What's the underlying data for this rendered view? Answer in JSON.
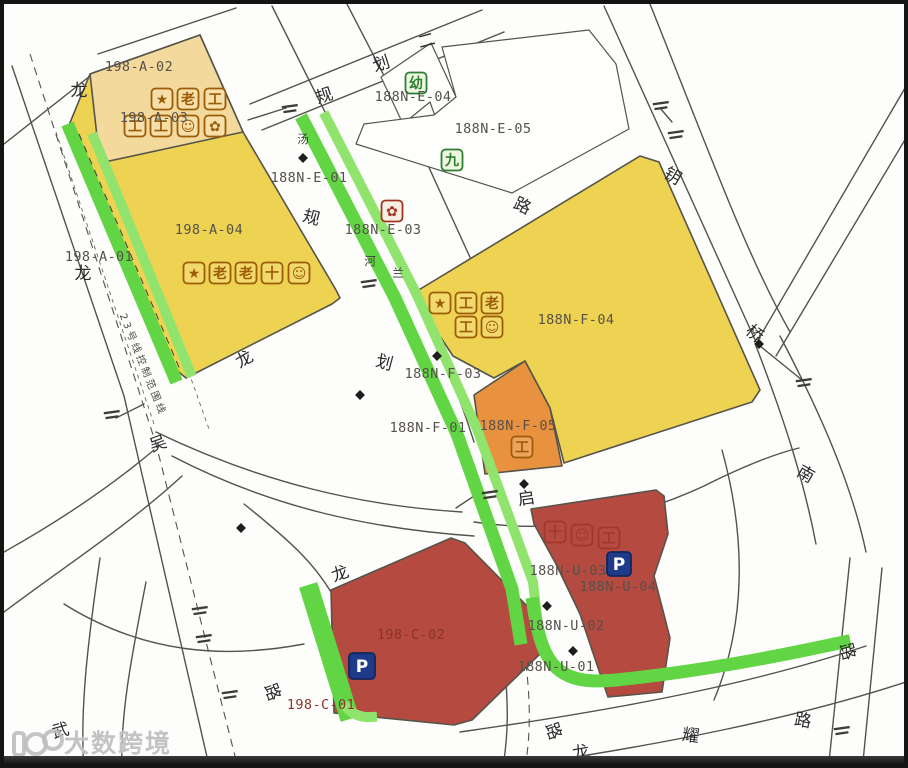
{
  "watermark": {
    "text": "大数跨境"
  },
  "colors": {
    "greenway": "#62d544",
    "greenway_light": "#90e46e",
    "parcel_yellow": "#eed252",
    "parcel_tan": "#f4d99c",
    "parcel_orange": "#e8913f",
    "parcel_red": "#b54a40",
    "parking_blue": "#1e3a8a",
    "icon_brown": "#9c5c08",
    "icon_green": "#2e7d32",
    "icon_red": "#a33322",
    "road_line": "#54524c",
    "label_gray": "#56514b",
    "label_red": "#8a342c"
  },
  "map": {
    "labels": [
      {
        "t": "198-A-02",
        "x": 135,
        "y": 67,
        "cls": "pl",
        "name": "parcel-label-198-a-02"
      },
      {
        "t": "198-A-03",
        "x": 150,
        "y": 118,
        "cls": "pl",
        "name": "parcel-label-198-a-03"
      },
      {
        "t": "198-A-04",
        "x": 205,
        "y": 230,
        "cls": "pl",
        "name": "parcel-label-198-a-04"
      },
      {
        "t": "198-A-01",
        "x": 95,
        "y": 257,
        "cls": "pl",
        "name": "parcel-label-198-a-01"
      },
      {
        "t": "188N-E-04",
        "x": 409,
        "y": 97,
        "cls": "pl",
        "name": "parcel-label-188n-e-04"
      },
      {
        "t": "188N-E-05",
        "x": 489,
        "y": 129,
        "cls": "pl",
        "name": "parcel-label-188n-e-05"
      },
      {
        "t": "188N-E-01",
        "x": 305,
        "y": 178,
        "cls": "pl",
        "name": "parcel-label-188n-e-01"
      },
      {
        "t": "188N-E-03",
        "x": 379,
        "y": 230,
        "cls": "pl",
        "name": "parcel-label-188n-e-03"
      },
      {
        "t": "188N-F-04",
        "x": 572,
        "y": 320,
        "cls": "pl",
        "name": "parcel-label-188n-f-04"
      },
      {
        "t": "188N-F-03",
        "x": 439,
        "y": 374,
        "cls": "pl",
        "name": "parcel-label-188n-f-03"
      },
      {
        "t": "188N-F-01",
        "x": 424,
        "y": 428,
        "cls": "pl",
        "name": "parcel-label-188n-f-01"
      },
      {
        "t": "188N-F-05",
        "x": 514,
        "y": 426,
        "cls": "pl",
        "name": "parcel-label-188n-f-05"
      },
      {
        "t": "198-C-02",
        "x": 407,
        "y": 635,
        "cls": "pl-red",
        "name": "parcel-label-198-c-02"
      },
      {
        "t": "198-C-01",
        "x": 317,
        "y": 705,
        "cls": "pl-red",
        "name": "parcel-label-198-c-01"
      },
      {
        "t": "188N-U-03",
        "x": 564,
        "y": 571,
        "cls": "pl",
        "name": "parcel-label-188n-u-03"
      },
      {
        "t": "188N-U-04",
        "x": 614,
        "y": 587,
        "cls": "pl",
        "name": "parcel-label-188n-u-04"
      },
      {
        "t": "188N-U-02",
        "x": 562,
        "y": 626,
        "cls": "pl",
        "name": "parcel-label-188n-u-02"
      },
      {
        "t": "188N-U-01",
        "x": 552,
        "y": 667,
        "cls": "pl",
        "name": "parcel-label-188n-u-01"
      },
      {
        "t": "龙",
        "x": 75,
        "y": 92,
        "cls": "rc",
        "name": "road-name-char"
      },
      {
        "t": "规",
        "x": 322,
        "y": 97,
        "cls": "rc",
        "rot": -18,
        "name": "road-name-char"
      },
      {
        "t": "划",
        "x": 379,
        "y": 65,
        "cls": "rc",
        "rot": -18,
        "name": "road-name-char"
      },
      {
        "t": "二",
        "x": 424,
        "y": 42,
        "cls": "rc",
        "rot": -15,
        "name": "road-name-char"
      },
      {
        "t": "路",
        "x": 516,
        "y": 207,
        "cls": "rc",
        "rot": 25,
        "name": "road-name-char"
      },
      {
        "t": "钥",
        "x": 666,
        "y": 177,
        "cls": "rc",
        "rot": 30,
        "name": "road-name-char"
      },
      {
        "t": "桥",
        "x": 747,
        "y": 334,
        "cls": "rc",
        "rot": 40,
        "name": "road-name-char"
      },
      {
        "t": "南",
        "x": 799,
        "y": 475,
        "cls": "rc",
        "rot": 30,
        "name": "road-name-char"
      },
      {
        "t": "龙",
        "x": 79,
        "y": 275,
        "cls": "rc",
        "name": "road-name-char"
      },
      {
        "t": "吴",
        "x": 156,
        "y": 445,
        "cls": "rc",
        "rot": -20,
        "name": "road-name-char"
      },
      {
        "t": "规",
        "x": 306,
        "y": 219,
        "cls": "rc",
        "rot": 15,
        "name": "road-name-char"
      },
      {
        "t": "划",
        "x": 379,
        "y": 364,
        "cls": "rc",
        "rot": 15,
        "name": "road-name-char"
      },
      {
        "t": "龙",
        "x": 243,
        "y": 360,
        "cls": "rc",
        "rot": -30,
        "name": "road-name-char"
      },
      {
        "t": "河",
        "x": 366,
        "y": 261,
        "cls": "rc-sm",
        "name": "road-name-char"
      },
      {
        "t": "兰",
        "x": 394,
        "y": 273,
        "cls": "rc-sm",
        "name": "road-name-char"
      },
      {
        "t": "汤",
        "x": 299,
        "y": 139,
        "cls": "rc-sm",
        "name": "road-name-char"
      },
      {
        "t": "启",
        "x": 523,
        "y": 500,
        "cls": "rc",
        "rot": -8,
        "name": "road-name-char"
      },
      {
        "t": "龙",
        "x": 338,
        "y": 575,
        "cls": "rc",
        "rot": -20,
        "name": "road-name-char"
      },
      {
        "t": "武",
        "x": 58,
        "y": 732,
        "cls": "rc",
        "rot": -15,
        "name": "road-name-char"
      },
      {
        "t": "路",
        "x": 263,
        "y": 690,
        "cls": "rc",
        "rot": 70,
        "name": "road-name-char"
      },
      {
        "t": "路",
        "x": 544,
        "y": 729,
        "cls": "rc",
        "rot": 70,
        "name": "road-name-char"
      },
      {
        "t": "龙",
        "x": 578,
        "y": 754,
        "cls": "rc",
        "rot": -10,
        "name": "road-name-char"
      },
      {
        "t": "耀",
        "x": 686,
        "y": 737,
        "cls": "rc",
        "rot": 8,
        "name": "road-name-char"
      },
      {
        "t": "路",
        "x": 798,
        "y": 722,
        "cls": "rc",
        "rot": 10,
        "name": "road-name-char"
      },
      {
        "t": "路",
        "x": 838,
        "y": 649,
        "cls": "rc",
        "rot": 75,
        "name": "road-name-char"
      },
      {
        "t": "23号线控制范围线",
        "x": 136,
        "y": 362,
        "cls": "metro",
        "rot": 68,
        "name": "metro-control-line-label"
      }
    ],
    "icons": [
      {
        "g": "★",
        "x": 158,
        "y": 95,
        "style": "brown",
        "name": "star-icon"
      },
      {
        "g": "老",
        "x": 184,
        "y": 95,
        "style": "brown",
        "name": "elderly-care-icon"
      },
      {
        "g": "工",
        "x": 211,
        "y": 95,
        "style": "brown",
        "name": "utility-icon"
      },
      {
        "g": "工",
        "x": 131,
        "y": 122,
        "style": "brown",
        "name": "utility-icon"
      },
      {
        "g": "工",
        "x": 157,
        "y": 122,
        "style": "brown",
        "name": "utility-icon"
      },
      {
        "g": "☺",
        "x": 184,
        "y": 122,
        "style": "brown",
        "name": "community-icon"
      },
      {
        "g": "✿",
        "x": 211,
        "y": 122,
        "style": "brown",
        "name": "station-icon"
      },
      {
        "g": "★",
        "x": 190,
        "y": 269,
        "style": "brown",
        "name": "star-icon"
      },
      {
        "g": "老",
        "x": 216,
        "y": 269,
        "style": "brown",
        "name": "elderly-care-icon"
      },
      {
        "g": "老",
        "x": 242,
        "y": 269,
        "style": "brown",
        "name": "elderly-care-icon"
      },
      {
        "g": "十",
        "x": 268,
        "y": 269,
        "style": "brown",
        "name": "clinic-icon"
      },
      {
        "g": "☺",
        "x": 295,
        "y": 269,
        "style": "brown",
        "name": "community-icon"
      },
      {
        "g": "★",
        "x": 436,
        "y": 299,
        "style": "brown",
        "name": "star-icon"
      },
      {
        "g": "工",
        "x": 462,
        "y": 299,
        "style": "brown",
        "name": "utility-icon"
      },
      {
        "g": "老",
        "x": 488,
        "y": 299,
        "style": "brown",
        "name": "elderly-care-icon"
      },
      {
        "g": "工",
        "x": 462,
        "y": 323,
        "style": "brown",
        "name": "utility-icon"
      },
      {
        "g": "☺",
        "x": 488,
        "y": 323,
        "style": "brown",
        "name": "community-icon"
      },
      {
        "g": "工",
        "x": 518,
        "y": 443,
        "style": "brown",
        "name": "utility-icon"
      },
      {
        "g": "✿",
        "x": 388,
        "y": 207,
        "style": "red",
        "name": "pump-station-icon"
      },
      {
        "g": "幼",
        "x": 412,
        "y": 79,
        "style": "green",
        "name": "kindergarten-icon"
      },
      {
        "g": "九",
        "x": 448,
        "y": 156,
        "style": "green",
        "name": "school-icon"
      },
      {
        "g": "十",
        "x": 551,
        "y": 528,
        "style": "faded",
        "name": "clinic-icon"
      },
      {
        "g": "☺",
        "x": 578,
        "y": 531,
        "style": "faded",
        "name": "community-icon"
      },
      {
        "g": "工",
        "x": 605,
        "y": 534,
        "style": "faded",
        "name": "utility-icon"
      },
      {
        "g": "P",
        "x": 358,
        "y": 662,
        "style": "psign",
        "w": 26,
        "name": "parking-sign"
      },
      {
        "g": "P",
        "x": 615,
        "y": 560,
        "style": "psign",
        "w": 24,
        "name": "parking-sign"
      }
    ],
    "annotation_marks": [
      {
        "x": 286,
        "y": 104
      },
      {
        "x": 657,
        "y": 101
      },
      {
        "x": 672,
        "y": 130
      },
      {
        "x": 800,
        "y": 378
      },
      {
        "x": 365,
        "y": 279
      },
      {
        "x": 108,
        "y": 410
      },
      {
        "x": 196,
        "y": 606
      },
      {
        "x": 200,
        "y": 634
      },
      {
        "x": 486,
        "y": 490
      },
      {
        "x": 838,
        "y": 726
      },
      {
        "x": 226,
        "y": 690
      }
    ],
    "survey_marks": [
      {
        "x": 299,
        "y": 154
      },
      {
        "x": 356,
        "y": 391
      },
      {
        "x": 433,
        "y": 352
      },
      {
        "x": 237,
        "y": 524
      },
      {
        "x": 520,
        "y": 480
      },
      {
        "x": 543,
        "y": 602
      },
      {
        "x": 569,
        "y": 647
      },
      {
        "x": 755,
        "y": 340
      }
    ]
  }
}
